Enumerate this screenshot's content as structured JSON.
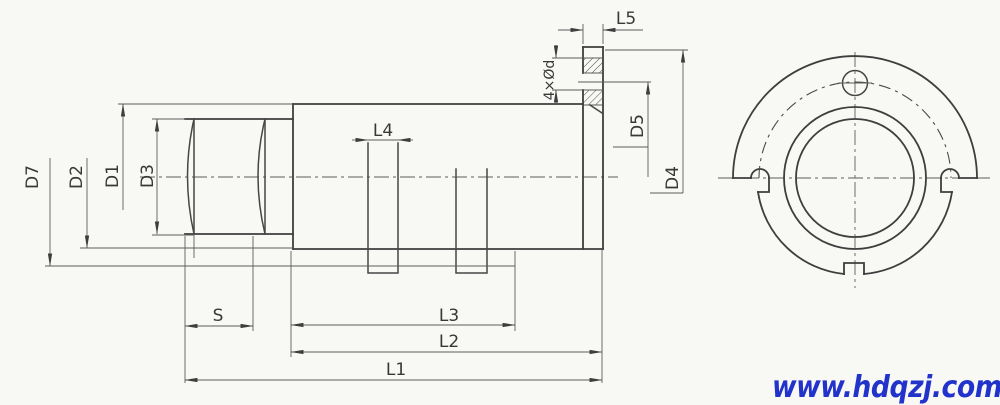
{
  "drawing": {
    "type": "technical-drawing",
    "views": [
      "side-section-view",
      "front-view"
    ],
    "background_color": "#f8f8f5",
    "line_color": "#3e3e3e"
  },
  "labels": {
    "d7": "D7",
    "d2": "D2",
    "d1": "D1",
    "d3": "D3",
    "d5": "D5",
    "d4": "D4",
    "holes": "4×Ød",
    "l1": "L1",
    "l2": "L2",
    "l3": "L3",
    "l4": "L4",
    "l5": "L5",
    "s": "S"
  },
  "watermark": {
    "text": "www.hdqzj.com",
    "color": "#2233cc"
  }
}
